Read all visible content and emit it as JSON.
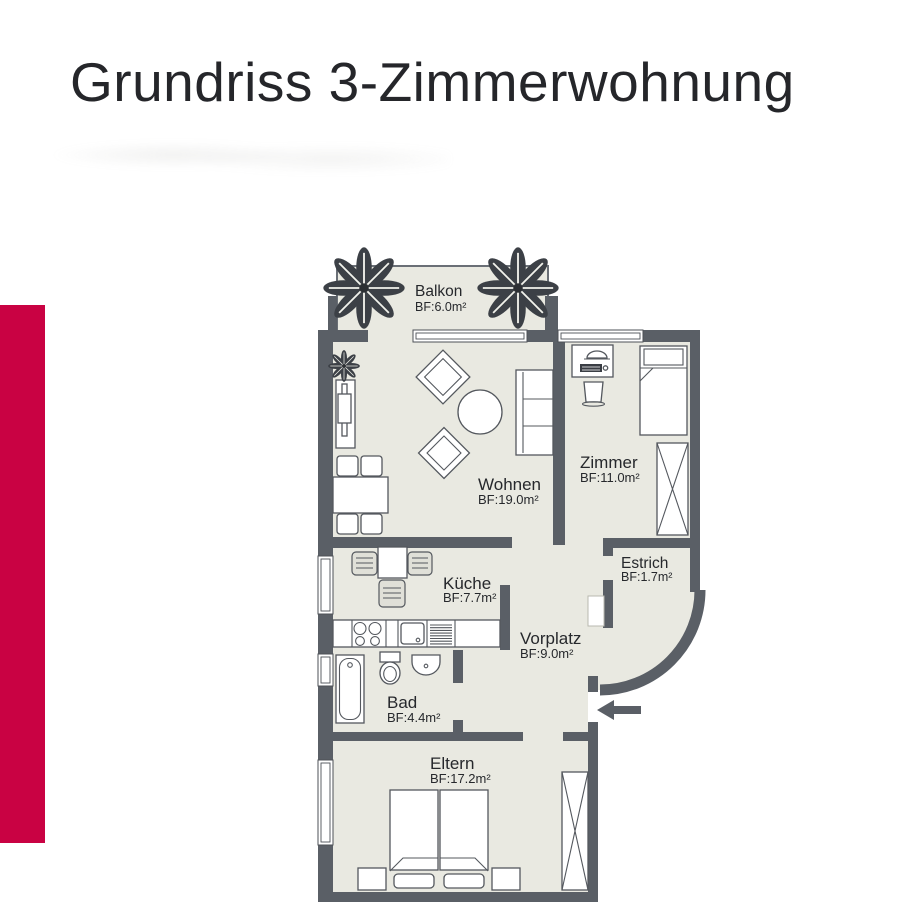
{
  "title": "Grundriss 3-Zimmerwohnung",
  "colors": {
    "accent_red": "#c90243",
    "wall_gray": "#5a5f66",
    "floor_beige": "#e9e9e1",
    "text": "#26282c"
  },
  "rooms": [
    {
      "name": "Balkon",
      "area": "BF:6.0m²"
    },
    {
      "name": "Wohnen",
      "area": "BF:19.0m²"
    },
    {
      "name": "Zimmer",
      "area": "BF:11.0m²"
    },
    {
      "name": "Küche",
      "area": "BF:7.7m²"
    },
    {
      "name": "Estrich",
      "area": "BF:1.7m²"
    },
    {
      "name": "Vorplatz",
      "area": "BF:9.0m²"
    },
    {
      "name": "Bad",
      "area": "BF:4.4m²"
    },
    {
      "name": "Eltern",
      "area": "BF:17.2m²"
    }
  ]
}
